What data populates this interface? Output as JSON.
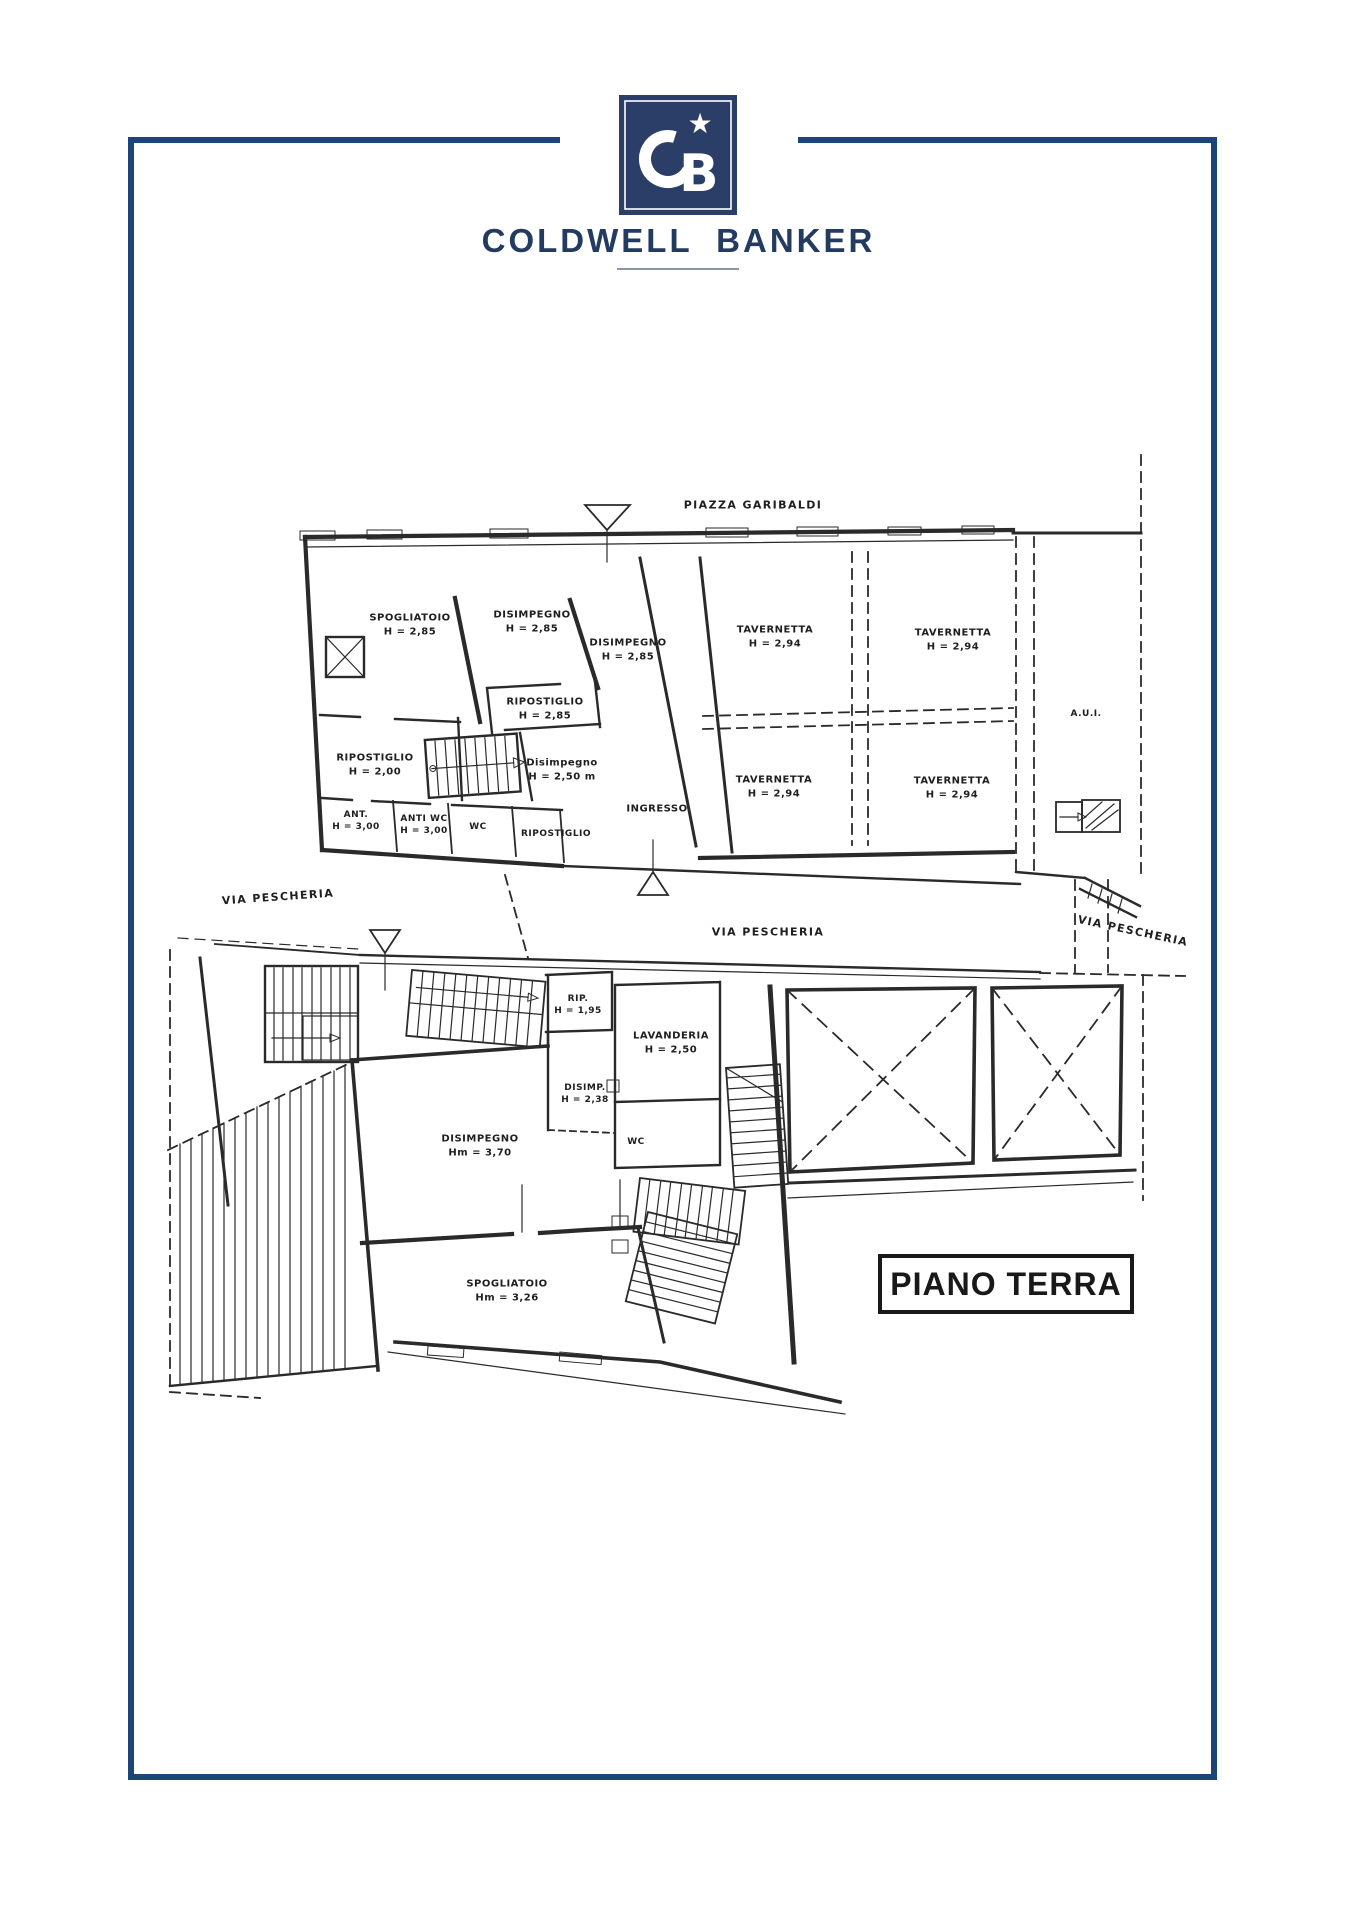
{
  "brand": {
    "wordmark": "COLDWELL BANKER",
    "monogram": "CB",
    "star": "★",
    "navy": "#2b3e68",
    "border_blue": "#1d4577"
  },
  "plan_label": {
    "text": "PIANO TERRA"
  },
  "streets": {
    "top": "PIAZZA GARIBALDI",
    "left": "VIA PESCHERIA",
    "middle": "VIA PESCHERIA",
    "right": "VIA PESCHERIA"
  },
  "upper_plan": {
    "rooms": [
      {
        "name": "SPOGLIATOIO",
        "height": "H = 2,85"
      },
      {
        "name": "DISIMPEGNO",
        "height": "H = 2,85"
      },
      {
        "name": "DISIMPEGNO",
        "height": "H = 2,85"
      },
      {
        "name": "RIPOSTIGLIO",
        "height": "H = 2,85"
      },
      {
        "name": "RIPOSTIGLIO",
        "height": "H = 2,00"
      },
      {
        "name": "Disimpegno",
        "height": "H = 2,50 m"
      },
      {
        "name": "ANT.",
        "height": "H = 3,00"
      },
      {
        "name": "ANTI WC",
        "height": "H = 3,00"
      },
      {
        "name": "WC",
        "height": ""
      },
      {
        "name": "RIPOSTIGLIO",
        "height": ""
      },
      {
        "name": "INGRESSO",
        "height": ""
      },
      {
        "name": "TAVERNETTA",
        "height": "H = 2,94"
      },
      {
        "name": "TAVERNETTA",
        "height": "H = 2,94"
      },
      {
        "name": "TAVERNETTA",
        "height": "H = 2,94"
      },
      {
        "name": "TAVERNETTA",
        "height": "H = 2,94"
      },
      {
        "name": "A.U.I.",
        "height": ""
      }
    ]
  },
  "lower_plan": {
    "rooms": [
      {
        "name": "RIP.",
        "height": "H = 1,95"
      },
      {
        "name": "LAVANDERIA",
        "height": "H = 2,50"
      },
      {
        "name": "DISIMP.",
        "height": "H = 2,38"
      },
      {
        "name": "WC",
        "height": ""
      },
      {
        "name": "DISIMPEGNO",
        "height": "Hm = 3,70"
      },
      {
        "name": "SPOGLIATOIO",
        "height": "Hm = 3,26"
      }
    ]
  }
}
